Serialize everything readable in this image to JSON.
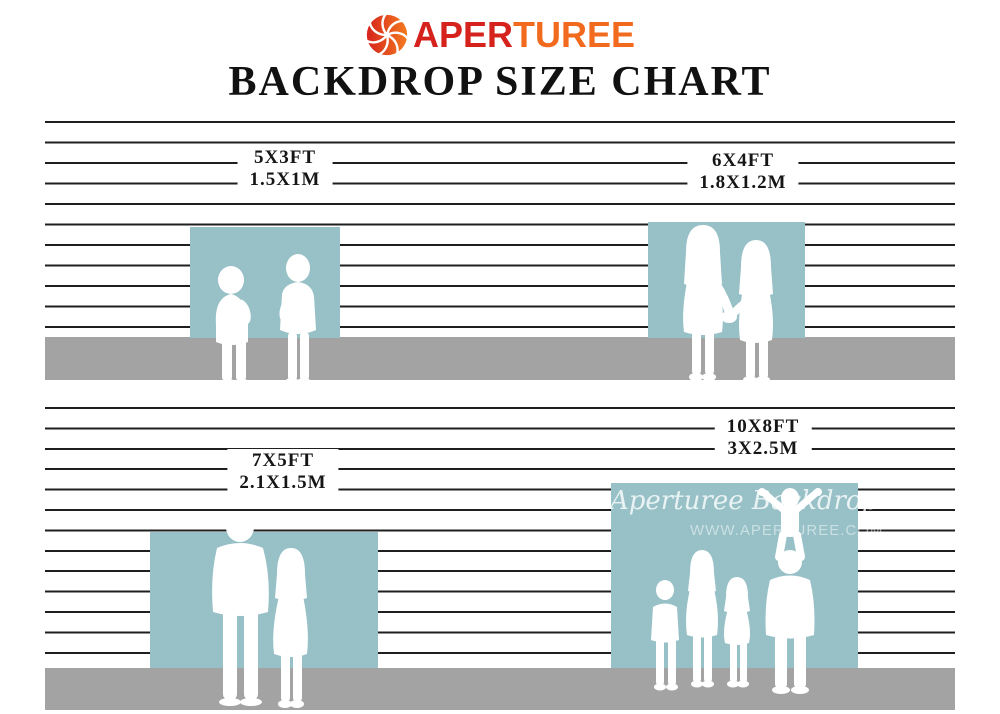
{
  "brand": {
    "logo_icon": "aperture-shutter-icon",
    "logo_text_primary": "APER",
    "logo_text_secondary": "TUREE"
  },
  "title": "BACKDROP SIZE CHART",
  "sizes": [
    {
      "ft": "5X3FT",
      "m": "1.5X1M"
    },
    {
      "ft": "6X4FT",
      "m": "1.8X1.2M"
    },
    {
      "ft": "7X5FT",
      "m": "2.1X1.5M"
    },
    {
      "ft": "10X8FT",
      "m": "3X2.5M"
    }
  ],
  "watermark": {
    "script": "Aperturee Backdrop",
    "url": "WWW.APERTUREE.COM"
  },
  "silhouettes": {
    "backdrop_5x3": "two-toddlers-silhouette",
    "backdrop_6x4": "mother-and-girl-silhouette",
    "backdrop_7x5": "man-and-woman-silhouette",
    "backdrop_10x8": "family-with-child-on-shoulders-silhouette"
  },
  "colors": {
    "brand_red": "#d6221c",
    "brand_orange": "#f26a1e",
    "backdrop_blue": "#97c0c7",
    "floor_gray": "#a3a3a3",
    "wall_line": "#1f1f1f",
    "title_black": "#111111"
  }
}
